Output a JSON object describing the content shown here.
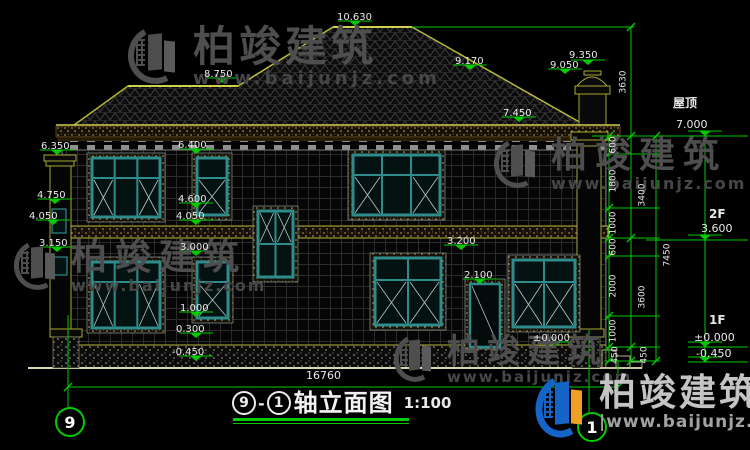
{
  "watermark": {
    "brand": "柏竣建筑",
    "url": "www.baijunjz.com",
    "url_bottom": "|www.baijunjz.com"
  },
  "footer": {
    "axis_from": "9",
    "axis_to": "1",
    "title": "轴立面图",
    "scale": "1:100",
    "axis_bubble_left": "9",
    "axis_bubble_right": "1"
  },
  "levels": {
    "ridge": "10.630",
    "left_ridge": "8.750",
    "right_slope": "9.170",
    "chimney_top": "9.350",
    "chimney_base": "9.050",
    "right_eave": "7.450",
    "left": [
      "6.350",
      "4.750",
      "4.050",
      "3.150"
    ],
    "center": [
      "6.400",
      "4.600",
      "4.050",
      "3.000",
      "1.000",
      "0.300",
      "-0.450"
    ],
    "mid_right": [
      "3.200",
      "2.100",
      "±0.000"
    ],
    "right_floors": [
      {
        "name": "屋顶",
        "value": "7.000"
      },
      {
        "name": "2F",
        "value": "3.600"
      },
      {
        "name": "1F",
        "value": "±0.000"
      },
      {
        "name": "",
        "value": "-0.450"
      }
    ]
  },
  "dims": {
    "chain_inner": [
      "600",
      "1800",
      "1000",
      "600",
      "2000",
      "1000",
      "450"
    ],
    "chain_mid": [
      "3630",
      "3400",
      "3600",
      "450"
    ],
    "chain_outer": [
      "7450"
    ],
    "total": "16760"
  },
  "colors": {
    "dimension": "#00cc00",
    "roof_line": "#b8b838",
    "window_frame": "#2e8c8c",
    "text": "#e8e8e8"
  }
}
